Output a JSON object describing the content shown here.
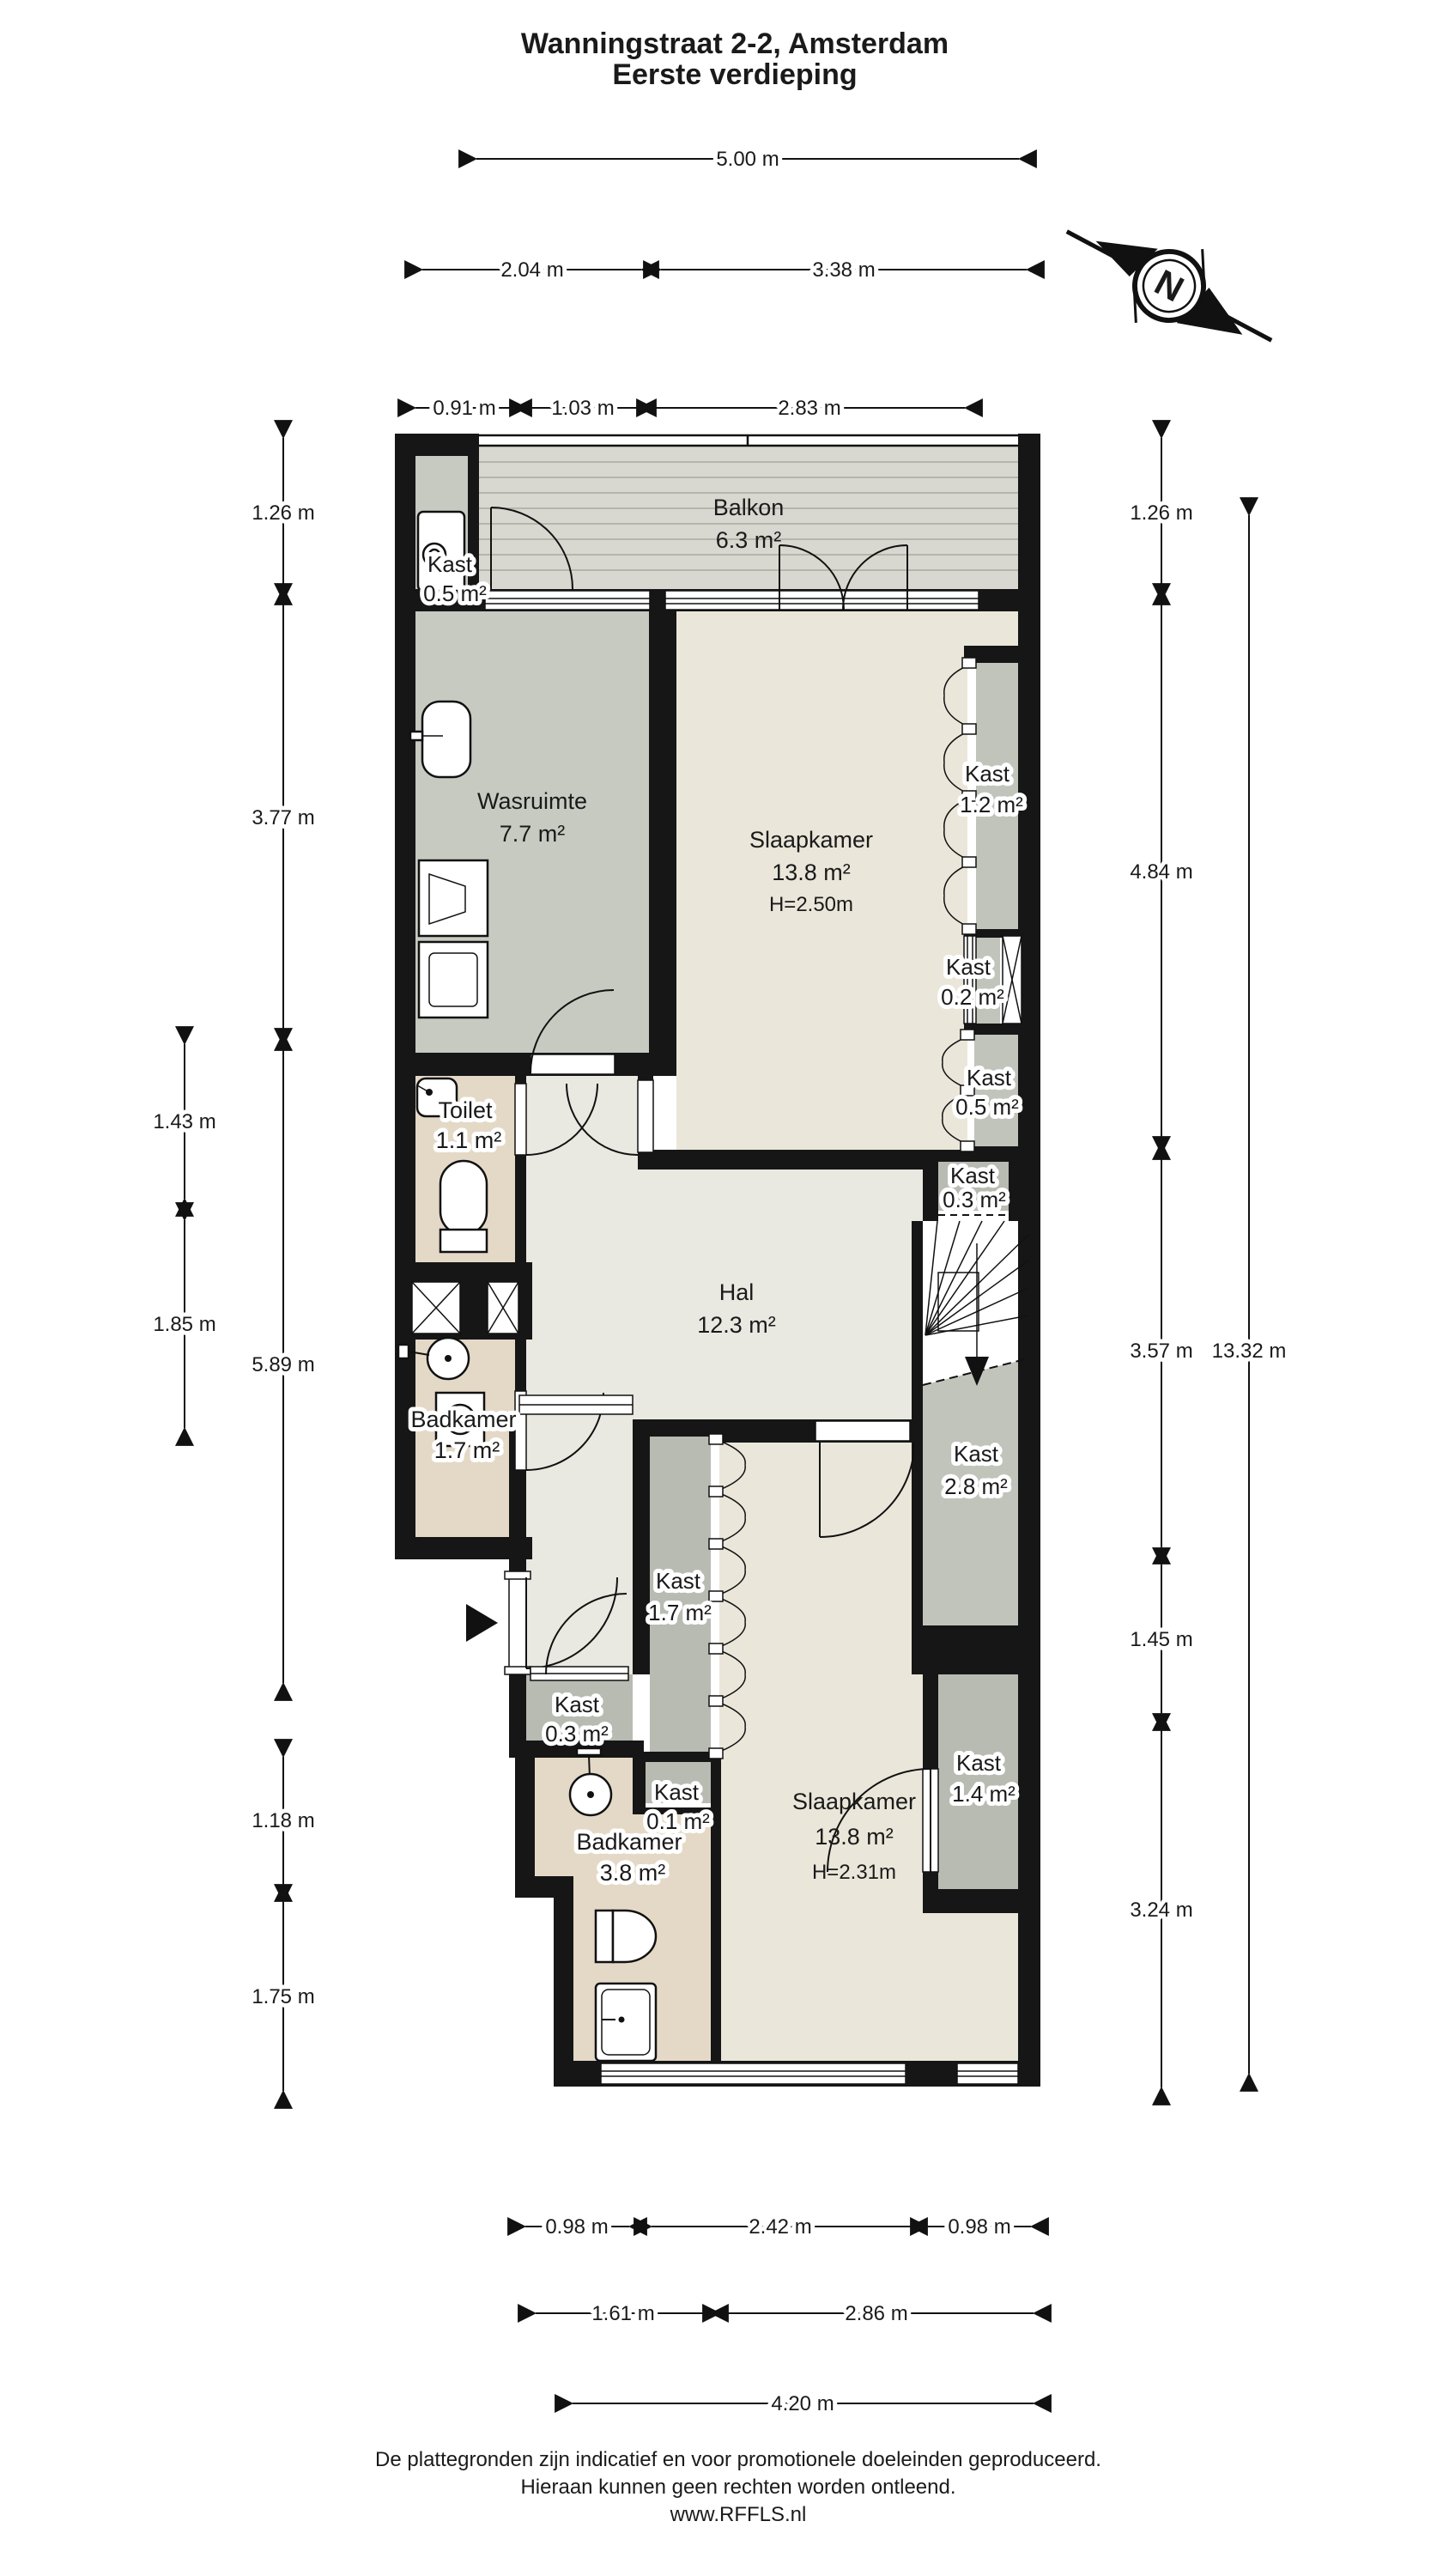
{
  "title": {
    "line1": "Wanningstraat 2-2, Amsterdam",
    "line2": "Eerste verdieping"
  },
  "compass": {
    "north_label": "N"
  },
  "rooms": {
    "kast05a": {
      "name": "Kast",
      "area": "0.5 m²"
    },
    "balkon": {
      "name": "Balkon",
      "area": "6.3 m²"
    },
    "wasruimte": {
      "name": "Wasruimte",
      "area": "7.7 m²"
    },
    "slaapkamer1": {
      "name": "Slaapkamer",
      "area": "13.8 m²",
      "height": "H=2.50m"
    },
    "kast12": {
      "name": "Kast",
      "area": "1.2 m²"
    },
    "kast02": {
      "name": "Kast",
      "area": "0.2 m²"
    },
    "kast05b": {
      "name": "Kast",
      "area": "0.5 m²"
    },
    "toilet": {
      "name": "Toilet",
      "area": "1.1 m²"
    },
    "badkamer1": {
      "name": "Badkamer",
      "area": "1.7 m²"
    },
    "hal": {
      "name": "Hal",
      "area": "12.3 m²"
    },
    "kast03r": {
      "name": "Kast",
      "area": "0.3 m²"
    },
    "kast28": {
      "name": "Kast",
      "area": "2.8 m²"
    },
    "kast17": {
      "name": "Kast",
      "area": "1.7 m²"
    },
    "kast14": {
      "name": "Kast",
      "area": "1.4 m²"
    },
    "kast03l": {
      "name": "Kast",
      "area": "0.3 m²"
    },
    "kast01": {
      "name": "Kast",
      "area": "0.1 m²"
    },
    "badkamer2": {
      "name": "Badkamer",
      "area": "3.8 m²"
    },
    "slaapkamer2": {
      "name": "Slaapkamer",
      "area": "13.8 m²",
      "height": "H=2.31m"
    }
  },
  "dims_top": {
    "d500": "5.00 m",
    "d204": "2.04 m",
    "d338": "3.38 m",
    "d091": "0.91 m",
    "d103": "1.03 m",
    "d283": "2.83 m"
  },
  "dims_left": {
    "d126": "1.26 m",
    "d377": "3.77 m",
    "d589": "5.89 m",
    "d143": "1.43 m",
    "d185": "1.85 m",
    "d118": "1.18 m",
    "d175": "1.75 m"
  },
  "dims_right": {
    "d126": "1.26 m",
    "d484": "4.84 m",
    "d357": "3.57 m",
    "d145": "1.45 m",
    "d324": "3.24 m",
    "d1332": "13.32 m"
  },
  "dims_bottom": {
    "d098a": "0.98 m",
    "d242": "2.42 m",
    "d098b": "0.98 m",
    "d161": "1.61 m",
    "d286": "2.86 m",
    "d420": "4.20 m"
  },
  "footer": {
    "line1": "De plattegronden zijn indicatief en voor promotionele doeleinden geproduceerd.",
    "line2": "Hieraan kunnen geen rechten worden ontleend.",
    "line3": "www.RFFLS.nl"
  },
  "colors": {
    "wall": "#161616",
    "floor_cream": "#eae6da",
    "floor_hal": "#e9e8e1",
    "floor_gray": "#c6cac1",
    "floor_gray_kast": "#c0c4bb",
    "floor_gray_dark": "#b7bbb2",
    "floor_beige": "#e4d9c7",
    "balcony_deck": "#d8d8d0"
  }
}
